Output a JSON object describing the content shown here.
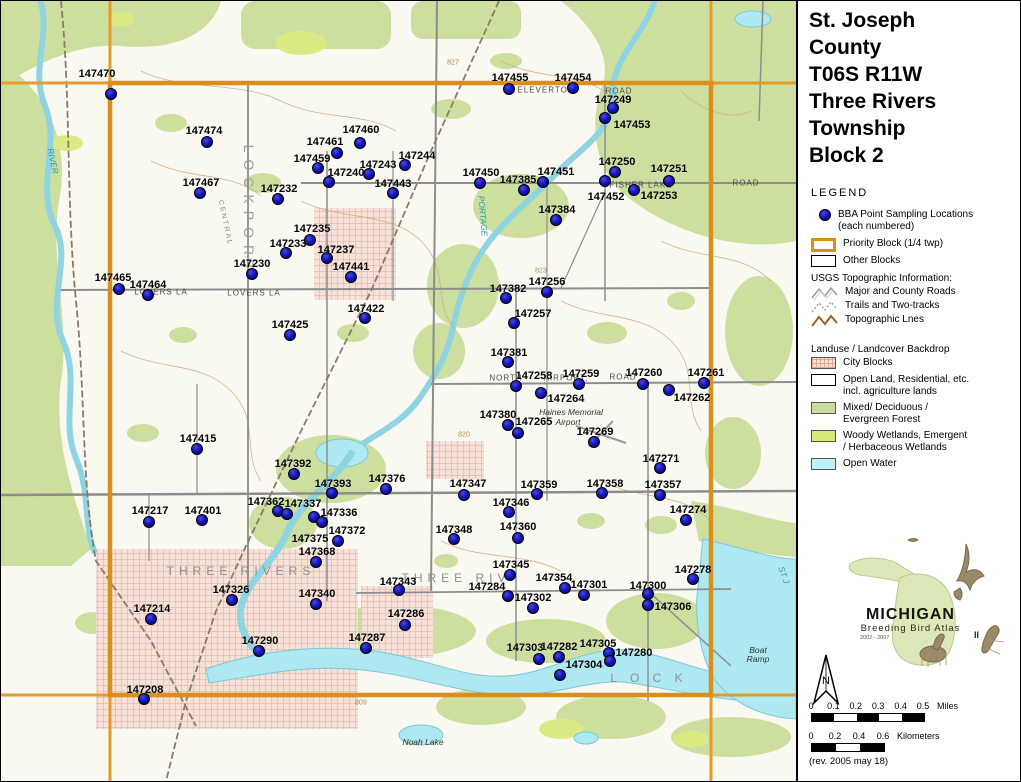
{
  "panel": {
    "title_lines": [
      "St. Joseph",
      "County",
      "T06S R11W",
      "Three Rivers",
      "Township",
      "Block 2"
    ],
    "legend_title": "LEGEND",
    "bba_item": {
      "line1": "BBA Point Sampling Locations",
      "line2": "(each numbered)"
    },
    "priority_label": "Priority Block (1/4 twp)",
    "other_label": "Other Blocks",
    "usgs_header": "USGS Topographic Information:",
    "usgs_items": [
      {
        "label": "Major and County Roads",
        "style": "road"
      },
      {
        "label": "Trails and Two-tracks",
        "style": "trail"
      },
      {
        "label": "Topographic Lnes",
        "style": "topo"
      }
    ],
    "landuse_header": "Landuse / Landcover Backdrop",
    "landuse_items": [
      {
        "label": "City Blocks",
        "label2": "",
        "swatch": "city"
      },
      {
        "label": "Open Land, Residential, etc.",
        "label2": "incl. agriculture lands",
        "swatch": "open"
      },
      {
        "label": "Mixed/ Deciduous /",
        "label2": "Evergreen Forest",
        "swatch": "forest"
      },
      {
        "label": "Woody Wetlands, Emergent",
        "label2": "/ Herbaceous Wetlands",
        "swatch": "wetland"
      },
      {
        "label": "Open Water",
        "label2": "",
        "swatch": "water"
      }
    ],
    "logo": {
      "name": "MICHIGAN",
      "subtitle": "Breeding Bird Atlas",
      "years": "2002 - 2007",
      "numeral": "II"
    },
    "north_label": "N",
    "scale_miles": {
      "ticks": [
        "0",
        "0.1",
        "0.2",
        "0.3",
        "0.4",
        "0.5"
      ],
      "unit": "Miles"
    },
    "scale_km": {
      "ticks": [
        "0",
        "0.2",
        "0.4",
        "0.6"
      ],
      "unit": "Kilometers"
    },
    "revision": "(rev. 2005 may 18)"
  },
  "map": {
    "colors": {
      "priority_border": "#d88f1e",
      "block_line": "#e49b2a",
      "point_fill": "#1616b6",
      "water": "#aee8f0",
      "forest": "#ccdf9f",
      "wetland": "#dcea86",
      "city": "#f6e2d8"
    },
    "points": [
      {
        "id": "147470",
        "lx": 96,
        "ly": 73,
        "dx": 110,
        "dy": 93
      },
      {
        "id": "147455",
        "lx": 509,
        "ly": 77,
        "dx": 508,
        "dy": 88
      },
      {
        "id": "147454",
        "lx": 572,
        "ly": 77,
        "dx": 572,
        "dy": 87
      },
      {
        "id": "147249",
        "lx": 612,
        "ly": 99,
        "dx": 612,
        "dy": 107
      },
      {
        "id": "147453",
        "lx": 631,
        "ly": 124,
        "dx": 604,
        "dy": 117
      },
      {
        "id": "147474",
        "lx": 203,
        "ly": 130,
        "dx": 206,
        "dy": 141
      },
      {
        "id": "147460",
        "lx": 360,
        "ly": 129,
        "dx": 359,
        "dy": 142
      },
      {
        "id": "147461",
        "lx": 324,
        "ly": 141,
        "dx": 336,
        "dy": 152
      },
      {
        "id": "147244",
        "lx": 416,
        "ly": 155,
        "dx": 404,
        "dy": 164
      },
      {
        "id": "147459",
        "lx": 311,
        "ly": 158,
        "dx": 317,
        "dy": 167
      },
      {
        "id": "147250",
        "lx": 616,
        "ly": 161,
        "dx": 614,
        "dy": 171
      },
      {
        "id": "147251",
        "lx": 668,
        "ly": 168,
        "dx": 668,
        "dy": 180
      },
      {
        "id": "147243",
        "lx": 377,
        "ly": 164,
        "dx": 368,
        "dy": 173
      },
      {
        "id": "147240",
        "lx": 345,
        "ly": 172,
        "dx": 328,
        "dy": 181
      },
      {
        "id": "147450",
        "lx": 480,
        "ly": 172,
        "dx": 479,
        "dy": 182
      },
      {
        "id": "147467",
        "lx": 200,
        "ly": 182,
        "dx": 199,
        "dy": 192
      },
      {
        "id": "147385",
        "lx": 517,
        "ly": 179,
        "dx": 523,
        "dy": 189
      },
      {
        "id": "147451",
        "lx": 555,
        "ly": 171,
        "dx": 542,
        "dy": 181
      },
      {
        "id": "147452",
        "lx": 605,
        "ly": 196,
        "dx": 604,
        "dy": 180
      },
      {
        "id": "147253",
        "lx": 658,
        "ly": 195,
        "dx": 633,
        "dy": 189
      },
      {
        "id": "147232",
        "lx": 278,
        "ly": 188,
        "dx": 277,
        "dy": 198
      },
      {
        "id": "147443",
        "lx": 392,
        "ly": 183,
        "dx": 392,
        "dy": 192
      },
      {
        "id": "147384",
        "lx": 556,
        "ly": 209,
        "dx": 555,
        "dy": 219
      },
      {
        "id": "147235",
        "lx": 311,
        "ly": 228,
        "dx": 309,
        "dy": 239
      },
      {
        "id": "147233",
        "lx": 287,
        "ly": 243,
        "dx": 285,
        "dy": 252
      },
      {
        "id": "147237",
        "lx": 335,
        "ly": 249,
        "dx": 326,
        "dy": 257
      },
      {
        "id": "147230",
        "lx": 251,
        "ly": 263,
        "dx": 251,
        "dy": 273
      },
      {
        "id": "147441",
        "lx": 350,
        "ly": 266,
        "dx": 350,
        "dy": 276
      },
      {
        "id": "147465",
        "lx": 112,
        "ly": 277,
        "dx": 118,
        "dy": 288
      },
      {
        "id": "147464",
        "lx": 147,
        "ly": 284,
        "dx": 147,
        "dy": 294
      },
      {
        "id": "147382",
        "lx": 507,
        "ly": 288,
        "dx": 505,
        "dy": 297
      },
      {
        "id": "147256",
        "lx": 546,
        "ly": 281,
        "dx": 546,
        "dy": 291
      },
      {
        "id": "147257",
        "lx": 532,
        "ly": 313,
        "dx": 513,
        "dy": 322
      },
      {
        "id": "147422",
        "lx": 365,
        "ly": 308,
        "dx": 364,
        "dy": 317
      },
      {
        "id": "147425",
        "lx": 289,
        "ly": 324,
        "dx": 289,
        "dy": 334
      },
      {
        "id": "147381",
        "lx": 508,
        "ly": 352,
        "dx": 507,
        "dy": 361
      },
      {
        "id": "147258",
        "lx": 533,
        "ly": 375,
        "dx": 515,
        "dy": 385
      },
      {
        "id": "147259",
        "lx": 580,
        "ly": 373,
        "dx": 578,
        "dy": 383
      },
      {
        "id": "147260",
        "lx": 643,
        "ly": 372,
        "dx": 642,
        "dy": 383
      },
      {
        "id": "147261",
        "lx": 705,
        "ly": 372,
        "dx": 703,
        "dy": 382
      },
      {
        "id": "147264",
        "lx": 565,
        "ly": 398,
        "dx": 540,
        "dy": 392
      },
      {
        "id": "147262",
        "lx": 691,
        "ly": 397,
        "dx": 668,
        "dy": 389
      },
      {
        "id": "147380",
        "lx": 497,
        "ly": 414,
        "dx": 507,
        "dy": 424
      },
      {
        "id": "147265",
        "lx": 533,
        "ly": 421,
        "dx": 517,
        "dy": 432
      },
      {
        "id": "147269",
        "lx": 594,
        "ly": 431,
        "dx": 593,
        "dy": 441
      },
      {
        "id": "147415",
        "lx": 197,
        "ly": 438,
        "dx": 196,
        "dy": 448
      },
      {
        "id": "147271",
        "lx": 660,
        "ly": 458,
        "dx": 659,
        "dy": 467
      },
      {
        "id": "147392",
        "lx": 292,
        "ly": 463,
        "dx": 293,
        "dy": 473
      },
      {
        "id": "147393",
        "lx": 332,
        "ly": 483,
        "dx": 331,
        "dy": 492
      },
      {
        "id": "147376",
        "lx": 386,
        "ly": 478,
        "dx": 385,
        "dy": 488
      },
      {
        "id": "147347",
        "lx": 467,
        "ly": 483,
        "dx": 463,
        "dy": 494
      },
      {
        "id": "147359",
        "lx": 538,
        "ly": 484,
        "dx": 536,
        "dy": 493
      },
      {
        "id": "147358",
        "lx": 604,
        "ly": 483,
        "dx": 601,
        "dy": 492
      },
      {
        "id": "147357",
        "lx": 662,
        "ly": 484,
        "dx": 659,
        "dy": 494
      },
      {
        "id": "147346",
        "lx": 510,
        "ly": 502,
        "dx": 508,
        "dy": 511
      },
      {
        "id": "147217",
        "lx": 149,
        "ly": 510,
        "dx": 148,
        "dy": 521
      },
      {
        "id": "147401",
        "lx": 202,
        "ly": 510,
        "dx": 201,
        "dy": 519
      },
      {
        "id": "147362",
        "lx": 265,
        "ly": 501,
        "dx": 277,
        "dy": 510
      },
      {
        "id": "147337",
        "lx": 302,
        "ly": 503,
        "dx": 286,
        "dy": 513
      },
      {
        "id": "147336",
        "lx": 338,
        "ly": 512,
        "dx": 313,
        "dy": 516
      },
      {
        "id": "147372",
        "lx": 346,
        "ly": 530,
        "dx": 321,
        "dy": 521
      },
      {
        "id": "147375",
        "lx": 309,
        "ly": 538,
        "dx": 337,
        "dy": 540
      },
      {
        "id": "147368",
        "lx": 316,
        "ly": 551,
        "dx": 315,
        "dy": 561
      },
      {
        "id": "147274",
        "lx": 687,
        "ly": 509,
        "dx": 685,
        "dy": 519
      },
      {
        "id": "147348",
        "lx": 453,
        "ly": 529,
        "dx": 453,
        "dy": 538
      },
      {
        "id": "147360",
        "lx": 517,
        "ly": 526,
        "dx": 517,
        "dy": 537
      },
      {
        "id": "147345",
        "lx": 510,
        "ly": 564,
        "dx": 509,
        "dy": 574
      },
      {
        "id": "147278",
        "lx": 692,
        "ly": 569,
        "dx": 692,
        "dy": 578
      },
      {
        "id": "147343",
        "lx": 397,
        "ly": 581,
        "dx": 398,
        "dy": 589
      },
      {
        "id": "147354",
        "lx": 553,
        "ly": 577,
        "dx": 564,
        "dy": 587
      },
      {
        "id": "147301",
        "lx": 588,
        "ly": 584,
        "dx": 583,
        "dy": 594
      },
      {
        "id": "147300",
        "lx": 647,
        "ly": 585,
        "dx": 647,
        "dy": 593
      },
      {
        "id": "147284",
        "lx": 486,
        "ly": 586,
        "dx": 507,
        "dy": 595
      },
      {
        "id": "147326",
        "lx": 230,
        "ly": 589,
        "dx": 231,
        "dy": 599
      },
      {
        "id": "147340",
        "lx": 316,
        "ly": 593,
        "dx": 315,
        "dy": 603
      },
      {
        "id": "147306",
        "lx": 672,
        "ly": 606,
        "dx": 647,
        "dy": 604
      },
      {
        "id": "147302",
        "lx": 532,
        "ly": 597,
        "dx": 532,
        "dy": 607
      },
      {
        "id": "147214",
        "lx": 151,
        "ly": 608,
        "dx": 150,
        "dy": 618
      },
      {
        "id": "147286",
        "lx": 405,
        "ly": 613,
        "dx": 404,
        "dy": 624
      },
      {
        "id": "147287",
        "lx": 366,
        "ly": 637,
        "dx": 365,
        "dy": 647
      },
      {
        "id": "147290",
        "lx": 259,
        "ly": 640,
        "dx": 258,
        "dy": 650
      },
      {
        "id": "147303",
        "lx": 524,
        "ly": 647,
        "dx": 538,
        "dy": 658
      },
      {
        "id": "147282",
        "lx": 558,
        "ly": 646,
        "dx": 558,
        "dy": 656
      },
      {
        "id": "147305",
        "lx": 597,
        "ly": 643,
        "dx": 608,
        "dy": 652
      },
      {
        "id": "147280",
        "lx": 633,
        "ly": 652,
        "dx": 609,
        "dy": 660
      },
      {
        "id": "147304",
        "lx": 583,
        "ly": 664,
        "dx": 559,
        "dy": 674
      },
      {
        "id": "147208",
        "lx": 144,
        "ly": 689,
        "dx": 143,
        "dy": 698
      }
    ],
    "labels": [
      {
        "t": "ELEVERTON",
        "x": 545,
        "y": 89,
        "c": "road",
        "r": 0
      },
      {
        "t": "ROAD",
        "x": 618,
        "y": 90,
        "c": "road",
        "r": 0
      },
      {
        "t": "FISHER  LAKE",
        "x": 640,
        "y": 184,
        "c": "road",
        "r": 0
      },
      {
        "t": "ROAD",
        "x": 745,
        "y": 182,
        "c": "road",
        "r": 0
      },
      {
        "t": "LOVERS  LA",
        "x": 160,
        "y": 291,
        "c": "road",
        "r": 0
      },
      {
        "t": "LOVERS  LA",
        "x": 253,
        "y": 292,
        "c": "road",
        "r": 0
      },
      {
        "t": "NORTH",
        "x": 505,
        "y": 377,
        "c": "road",
        "r": 0
      },
      {
        "t": "AIRPORT,",
        "x": 565,
        "y": 377,
        "c": "road",
        "r": 0
      },
      {
        "t": "ROAD",
        "x": 622,
        "y": 376,
        "c": "road",
        "r": 0
      },
      {
        "t": "Haines Memorial",
        "x": 570,
        "y": 411,
        "c": "place",
        "r": 0
      },
      {
        "t": "Airport",
        "x": 567,
        "y": 421,
        "c": "place",
        "r": 0
      },
      {
        "t": "THREE  RIVERS",
        "x": 240,
        "y": 570,
        "c": "city",
        "r": 0
      },
      {
        "t": "THREE  RIV",
        "x": 455,
        "y": 577,
        "c": "city",
        "r": 0
      },
      {
        "t": "L   O   C   K",
        "x": 648,
        "y": 677,
        "c": "city",
        "r": 0
      },
      {
        "t": "LOCKPORT",
        "x": 248,
        "y": 210,
        "c": "twp",
        "r": 90
      },
      {
        "t": "CENTRAL",
        "x": 224,
        "y": 222,
        "c": "rail",
        "r": 78
      },
      {
        "t": "PORTAGE",
        "x": 482,
        "y": 215,
        "c": "wtr",
        "r": 85
      },
      {
        "t": "ST  J",
        "x": 783,
        "y": 574,
        "c": "wtr",
        "r": 70
      },
      {
        "t": "RIVER",
        "x": 52,
        "y": 160,
        "c": "wtr",
        "r": 78
      },
      {
        "t": "Noah Lake",
        "x": 422,
        "y": 741,
        "c": "place",
        "r": 0
      },
      {
        "t": "Boat",
        "x": 757,
        "y": 649,
        "c": "place",
        "r": 0
      },
      {
        "t": "Ramp",
        "x": 757,
        "y": 658,
        "c": "place",
        "r": 0
      },
      {
        "t": "827",
        "x": 452,
        "y": 62,
        "c": "cont",
        "r": 0
      },
      {
        "t": "823",
        "x": 540,
        "y": 270,
        "c": "cont",
        "r": 0
      },
      {
        "t": "820",
        "x": 463,
        "y": 434,
        "c": "cont",
        "r": 0
      },
      {
        "t": "809",
        "x": 360,
        "y": 702,
        "c": "cont",
        "r": 0
      }
    ]
  }
}
